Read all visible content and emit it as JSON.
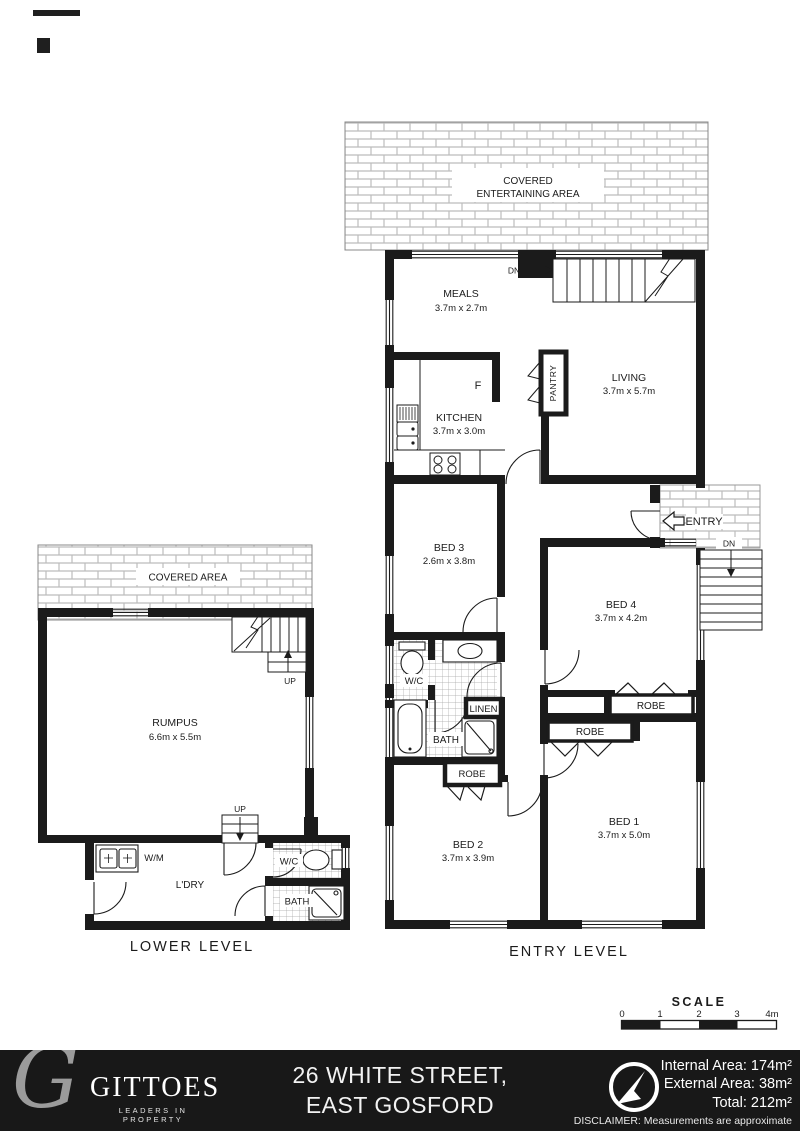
{
  "lower_level": {
    "title": "LOWER LEVEL",
    "covered_area": "COVERED AREA",
    "rumpus": {
      "name": "RUMPUS",
      "dims": "6.6m x 5.5m"
    },
    "up_stair1": "UP",
    "up_stair2": "UP",
    "wm": "W/M",
    "ldry": "L'DRY",
    "wc": "W/C",
    "bath": "BATH"
  },
  "entry_level": {
    "title": "ENTRY LEVEL",
    "covered_line1": "COVERED",
    "covered_line2": "ENTERTAINING AREA",
    "meals": {
      "name": "MEALS",
      "dims": "3.7m x 2.7m"
    },
    "kitchen": {
      "name": "KITCHEN",
      "dims": "3.7m x 3.0m"
    },
    "living": {
      "name": "LIVING",
      "dims": "3.7m x 5.7m"
    },
    "pantry": "PANTRY",
    "fridge": "F",
    "entry": "ENTRY",
    "dn_internal": "DN",
    "dn_external": "DN",
    "bed1": {
      "name": "BED 1",
      "dims": "3.7m x 5.0m"
    },
    "bed2": {
      "name": "BED 2",
      "dims": "3.7m x 3.9m"
    },
    "bed3": {
      "name": "BED 3",
      "dims": "2.6m x 3.8m"
    },
    "bed4": {
      "name": "BED 4",
      "dims": "3.7m x 4.2m"
    },
    "wc": "W/C",
    "bath": "BATH",
    "linen": "LINEN",
    "robe_bed2": "ROBE",
    "robe_bed4": "ROBE",
    "robe_bed1": "ROBE"
  },
  "scale": {
    "title": "SCALE",
    "tick0": "0",
    "tick1": "1",
    "tick2": "2",
    "tick3": "3",
    "tick4": "4m"
  },
  "footer": {
    "monogram": "G",
    "brand": "GITTOES",
    "tagline": "LEADERS IN PROPERTY",
    "address_line1": "26 WHITE STREET,",
    "address_line2": "EAST GOSFORD",
    "internal_area": "Internal Area: 174m²",
    "external_area": "External Area: 38m²",
    "total_area": "Total: 212m²",
    "disclaimer": "DISCLAIMER: Measurements are approximate"
  },
  "colors": {
    "wall": "#1b1b1b",
    "footer_bg": "#181818",
    "tile_line": "#bcbcbc",
    "grid_line": "#a5a5a5",
    "logo_gray": "#9b9b9b"
  }
}
